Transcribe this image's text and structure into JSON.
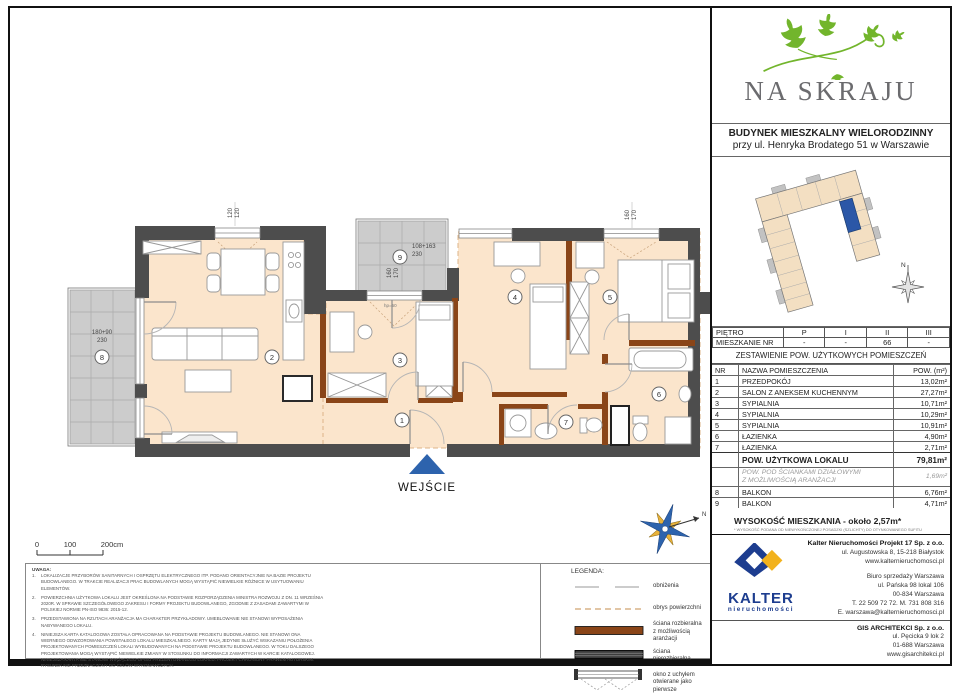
{
  "colors": {
    "floor": "#fbe5cc",
    "wall": "#4d4d4d",
    "partition_brown": "#8a4518",
    "balcony_gray": "#cccccc",
    "accent_blue": "#2d63ad",
    "leaf_green": "#72b52c",
    "logo_gray": "#6b6b6e",
    "kalter_navy": "#1d3d8f",
    "kalter_yellow": "#f2b21d"
  },
  "logo": {
    "name": "NA SKRAJU"
  },
  "building": {
    "line1": "BUDYNEK MIESZKALNY WIELORODZINNY",
    "line2": "przy ul. Henryka Brodatego 51 w Warszawie"
  },
  "floor_table": {
    "floor_label": "PIĘTRO",
    "floors": [
      "P",
      "I",
      "II",
      "III"
    ],
    "apt_label": "MIESZKANIE NR",
    "apts": [
      "-",
      "-",
      "66",
      "-"
    ]
  },
  "area_table": {
    "title": "ZESTAWIENIE POW. UŻYTKOWYCH POMIESZCZEŃ",
    "col_nr": "NR",
    "col_name": "NAZWA POMIESZCZENIA",
    "col_area": "POW. (m²)",
    "rows": [
      {
        "nr": "1",
        "name": "PRZEDPOKÓJ",
        "area": "13,02m²"
      },
      {
        "nr": "2",
        "name": "SALON Z ANEKSEM KUCHENNYM",
        "area": "27,27m²"
      },
      {
        "nr": "3",
        "name": "SYPIALNIA",
        "area": "10,71m²"
      },
      {
        "nr": "4",
        "name": "SYPIALNIA",
        "area": "10,29m²"
      },
      {
        "nr": "5",
        "name": "SYPIALNIA",
        "area": "10,91m²"
      },
      {
        "nr": "6",
        "name": "ŁAZIENKA",
        "area": "4,90m²"
      },
      {
        "nr": "7",
        "name": "ŁAZIENKA",
        "area": "2,71m²"
      }
    ],
    "total_label": "POW. UŻYTKOWA LOKALU",
    "total_area": "79,81m²",
    "partition_line1": "POW. POD ŚCIANKAMI DZIAŁOWYMI",
    "partition_line2": "Z MOŻLIWOŚCIĄ ARANŻACJI",
    "partition_area": "1,69m²",
    "balconies": [
      {
        "nr": "8",
        "name": "BALKON",
        "area": "6,76m²"
      },
      {
        "nr": "9",
        "name": "BALKON",
        "area": "4,71m²"
      }
    ],
    "height_label": "WYSOKOŚĆ MIESZKANIA - około 2,57m*",
    "height_footnote": "* WYSOKOŚĆ PODANA OD NIEWYKOŃCZONEJ POSADZKI (SZLICHTY) DO OTYNKOWANEGO SUFITU"
  },
  "plan": {
    "entrance": "WEJŚCIE",
    "north": "N",
    "rooms": {
      "r1": "1",
      "r2": "2",
      "r3": "3",
      "r4": "4",
      "r5": "5",
      "r6": "6",
      "r7": "7",
      "r8": "8",
      "r9": "9"
    },
    "dims": {
      "top_left_a": "120",
      "top_left_b": "120",
      "b9_w": "108+163",
      "b9_d": "230",
      "b9_va": "160",
      "b9_vb": "170",
      "top_right_a": "160",
      "top_right_b": "170",
      "b8_w": "180+90",
      "b8_d": "230",
      "hp": "hp=60"
    }
  },
  "scale": {
    "t0": "0",
    "t1": "100",
    "t2": "200cm"
  },
  "notes": {
    "title": "UWAGA:",
    "items": [
      {
        "num": "1.",
        "text": "LOKALIZACJE PRZYBORÓW SANITARNYCH I OSPRZĘTU ELEKTRYCZNEGO ITP. PODANO ORIENTACYJNIE NA BAZIE PROJEKTU BUDOWLANEGO. W TRAKCIE REALIZACJI PRAC BUDOWLANYCH MOGĄ WYSTĄPIĆ NIEWIELKIE RÓŻNICE W USYTUOWANIU ELEMENTÓW."
      },
      {
        "num": "2.",
        "text": "POWIERZCHNIA UŻYTKOWA LOKALU JEST OKREŚLONA NA PODSTAWIE ROZPORZĄDZENIA MINISTRA ROZWOJU Z DN. 11 WRZEŚNIA 2020R. W SPRAWIE SZCZEGÓŁOWEGO ZAKRESU I FORMY PROJEKTU BUDOWLANEGO, ZGODNIE Z ZASADAMI ZAWARTYMI W POLSKIEJ NORMIE PN-ISO 9836: 2015-12."
      },
      {
        "num": "3.",
        "text": "PRZEDSTAWIONA NA RZUTACH ARANŻACJA MA CHARAKTER PRZYKŁADOWY. UMEBLOWANIE NIE STANOWI WYPOSAŻENIA NABYWANEGO LOKALU."
      },
      {
        "num": "4.",
        "text": "NINIEJSZA KARTA KATALOGOWA ZOSTAŁA OPRACOWANA NA PODSTAWIE PROJEKTU BUDOWLANEGO. NIE STANOWI ONA WIERNEGO ODWZOROWANIA POWSTAŁEGO LOKALU MIESZKALNEGO. KARTY MAJĄ JEDYNIE SŁUŻYĆ WSKAZANIU POŁOŻENIA PROJEKTOWANYCH POMIESZCZEŃ LOKALI WYBUDOWANYCH NA PODSTAWIE PROJEKTU BUDOWLANEGO. W TOKU DALSZEGO PROJEKTOWANIA MOGĄ WYSTĄPIĆ NIEWIELKIE ZMIANY W STOSUNKU DO INFORMACJI ZAWARTYCH W KARCIE KATALOGOWEJ. NINIEJSZA KARTA NIE STANOWI WIĄŻĄCEGO OPISU PREZENTOWANEGO LOKALU. PROJEKT CHRONIONY PRAWEM AUTORSKIM. RYSUNEK NIE PRZEZNACZONY DO CELÓW WYKONAWCZYCH."
      }
    ]
  },
  "legend": {
    "title": "LEGENDA:",
    "i1": "obniżenia",
    "i2": "obrys powierzchni",
    "i3a": "ściana rozbieralna",
    "i3b": "z możliwością aranżacji",
    "i4": "ściana nierozbieralna",
    "i5a": "okno z uchyłem",
    "i5b": "otwierane jako pierwsze"
  },
  "footer": {
    "brand": "KALTER",
    "brand_sub": "nieruchomości",
    "company_name": "Kalter Nieruchomości Projekt 17 Sp. z o.o.",
    "company_addr": "ul. Augustowska 8, 15-218 Białystok",
    "company_web": "www.kalternieruchomosci.pl",
    "office_name": "Biuro sprzedaży Warszawa",
    "office_addr1": "ul. Pańska 98 lokal 106",
    "office_addr2": "00-834 Warszawa",
    "office_phone": "T. 22 509 72 72. M. 731 808 316",
    "office_email": "E. warszawa@kalternieruchomosci.pl",
    "arch_name": "GIS ARCHITEKCI Sp. z o.o.",
    "arch_addr1": "ul. Pęcicka 9 lok 2",
    "arch_addr2": "01-688 Warszawa",
    "arch_web": "www.gisarchitekci.pl"
  }
}
